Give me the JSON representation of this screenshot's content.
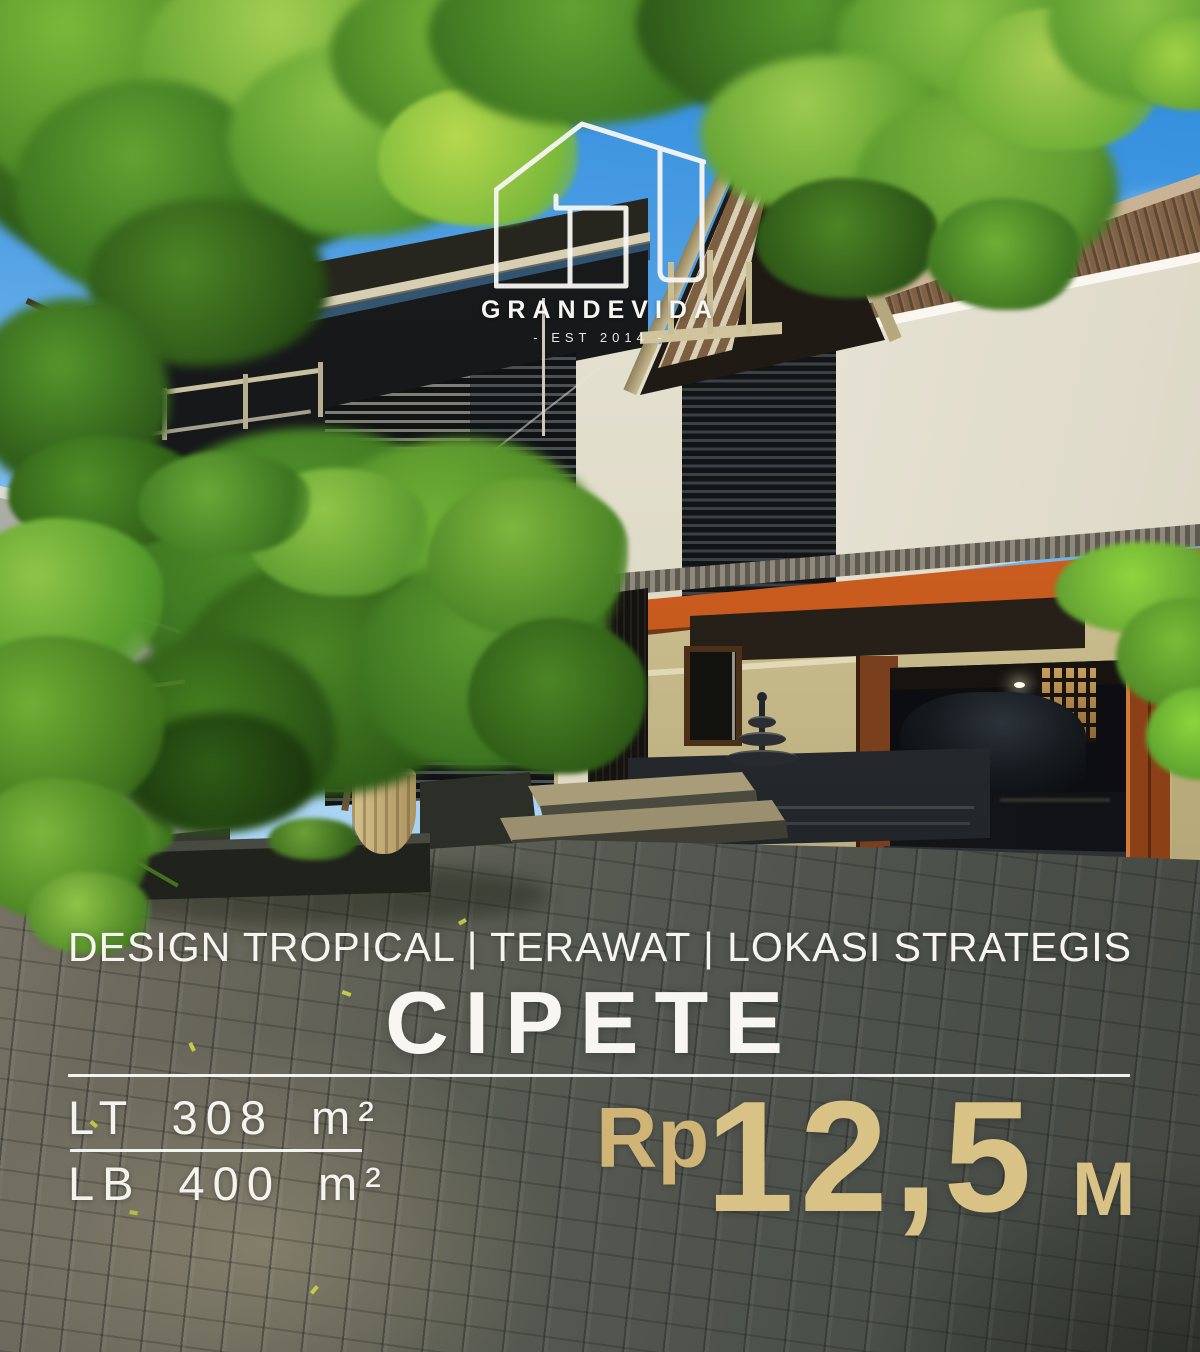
{
  "brand": {
    "name": "GRANDEVIDA",
    "established": "- EST 2014 -",
    "logo_icon": "house-outline-icon"
  },
  "caption": {
    "tagline": "DESIGN TROPICAL | TERAWAT | LOKASI STRATEGIS",
    "location": "CIPETE"
  },
  "specs": {
    "land": "LT 308 m²",
    "building": "LB 400 m²"
  },
  "price": {
    "currency": "Rp",
    "amount": "12,5",
    "unit": "M"
  },
  "colors": {
    "accent_gold": "#d8c286",
    "text_white": "#f5f4ee",
    "fascia_orange": "#c9571c",
    "sky_blue": "#3d96dd"
  }
}
